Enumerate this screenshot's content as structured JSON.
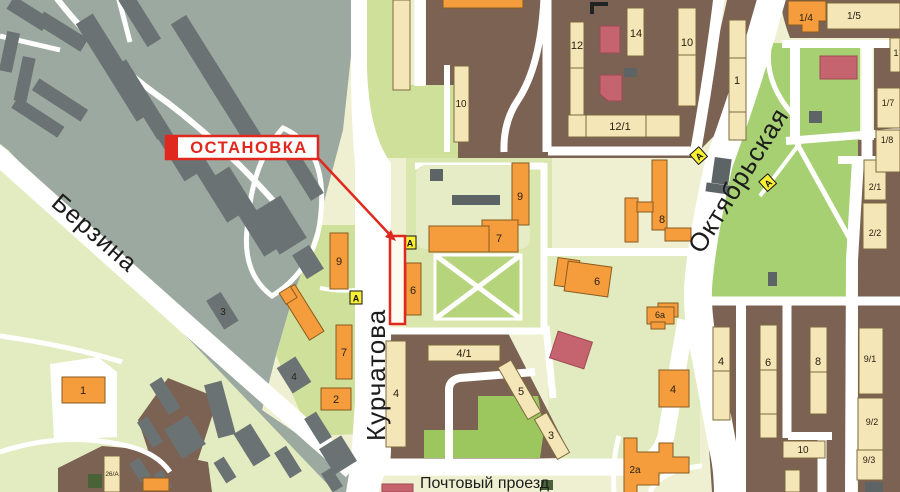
{
  "stop": {
    "label": "ОСТАНОВКА",
    "marker_letter": "А"
  },
  "streets": {
    "berzina": "Берзина",
    "kurchatova": "Курчатова",
    "oktyabrskaya": "Октябрьская",
    "pochtovy": "Почтовый проезд"
  },
  "labels": {
    "b12": "12",
    "b14": "14",
    "b10_top": "10",
    "b1_top": "1",
    "b12_1": "12/1",
    "b10_mid": "10",
    "b9_east": "9",
    "b7_east": "7",
    "b6_mid": "6",
    "b8_mid": "8",
    "b6a": "6a",
    "b4_right": "4",
    "b2a": "2a",
    "b9_west": "9",
    "b7_west": "7",
    "b2_west": "2",
    "b6_east": "6",
    "b1_west": "1",
    "b26a": "26/A",
    "b3_gray": "3",
    "b4_gray": "4",
    "b4_post": "4",
    "b4_1": "4/1",
    "b5_post": "5",
    "b3_post": "3",
    "b4_col": "4",
    "b6_col": "6",
    "b8_col": "8",
    "b10_col": "10",
    "b9_1": "9/1",
    "b9_2": "9/2",
    "b9_3": "9/3",
    "b2_1": "2/1",
    "b2_2": "2/2",
    "b1_4": "1/4",
    "b1_5": "1/5",
    "b1_6": "1",
    "b1_7": "1/7",
    "b1_8": "1/8"
  },
  "colors": {
    "accent_red": "#e0281e",
    "building_orange": "#f59d3c",
    "building_cream": "#f4e6b6",
    "block_brown": "#7b6253",
    "industrial_gray": "#9ca9a0",
    "building_dark_gray": "#6b7274",
    "park_green": "#a6d072",
    "marker_yellow": "#f9ef35",
    "building_pink": "#c5636e",
    "road_white": "#ffffff"
  }
}
